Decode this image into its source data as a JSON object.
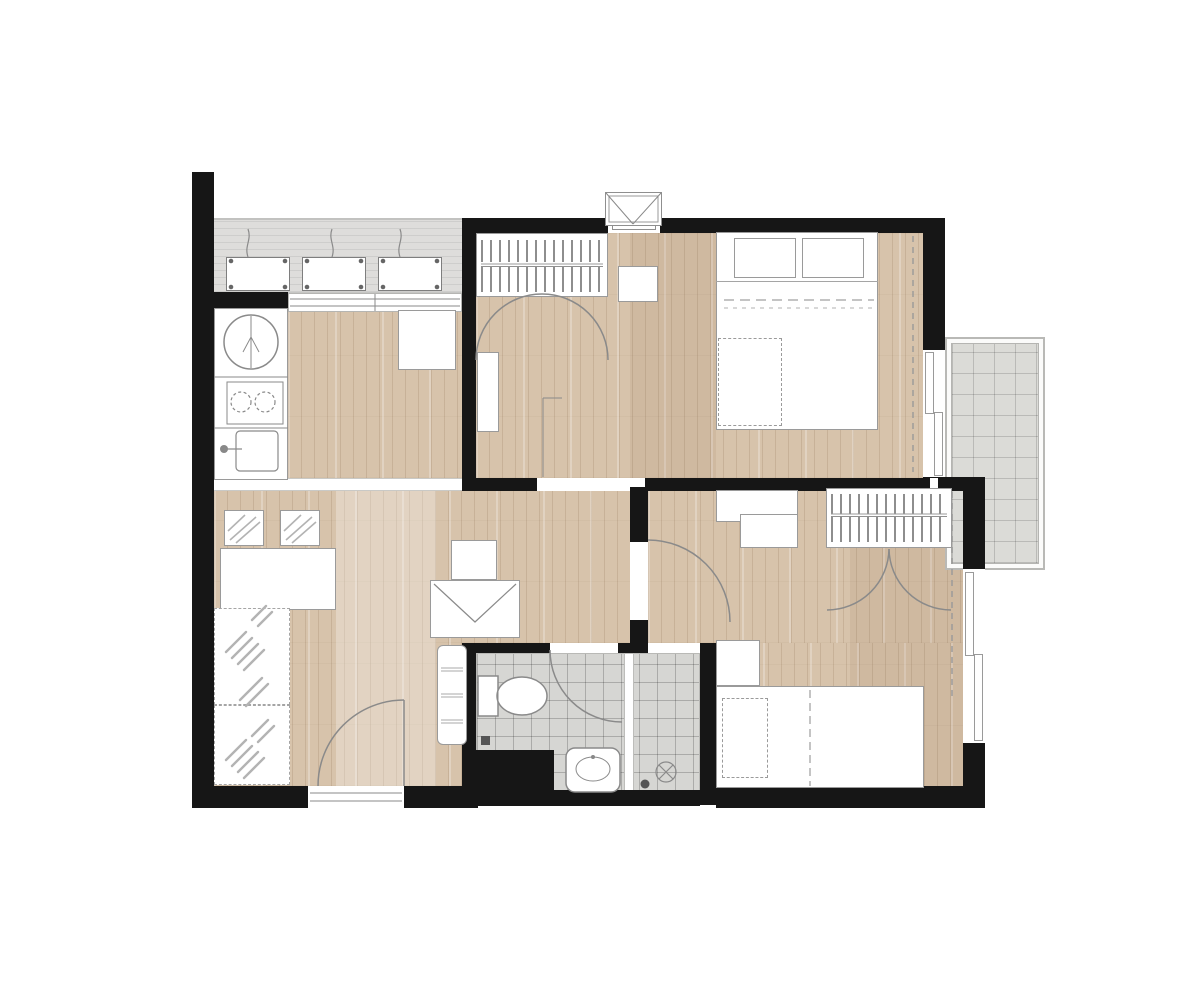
{
  "title": "Two-bedroom apartment floor plan (top view)",
  "colors": {
    "wall": "#161616",
    "wood_floor": "#d7c3ab",
    "wood_plank_line": "#b79a7c",
    "ac_ledge": "#dedddb",
    "balcony_tile": "#dbdbd7",
    "bathroom_tile": "#d6d6d3",
    "furniture_fill": "#ffffff",
    "furniture_outline": "#9a9a9a",
    "door_swing_arc": "#8a8a8a",
    "background": "#ffffff"
  },
  "rooms": [
    {
      "id": "ac-ledge",
      "symbols": [
        "ac-compressor-unit",
        "ac-compressor-unit",
        "ac-compressor-unit",
        "sliding-window-sill"
      ]
    },
    {
      "id": "kitchen",
      "symbols": [
        "counter",
        "washing-machine",
        "two-burner-cooktop",
        "kitchen-sink",
        "refrigerator"
      ]
    },
    {
      "id": "foyer",
      "symbols": [
        "wardrobe-hanging-rail",
        "double-door-swing-arcs",
        "mirror-cabinet",
        "entrance-door"
      ]
    },
    {
      "id": "service-shaft",
      "symbols": [
        "shaft-box"
      ]
    },
    {
      "id": "bedroom-1",
      "symbols": [
        "double-bed",
        "pillow",
        "pillow",
        "bed-runner",
        "nightstand",
        "curtain-line",
        "sliding-balcony-door"
      ]
    },
    {
      "id": "balcony",
      "symbols": [
        "tile-grid"
      ]
    },
    {
      "id": "living-dining",
      "symbols": [
        "dining-chair",
        "dining-chair",
        "dining-table",
        "plant-mat",
        "plant-mat",
        "desk-chair",
        "desk",
        "slim-cabinet",
        "swing-door-window"
      ]
    },
    {
      "id": "bathroom",
      "symbols": [
        "toilet",
        "washbasin",
        "shower-partition",
        "floor-drain",
        "shower-head",
        "door-swing-arc"
      ]
    },
    {
      "id": "bedroom-2",
      "symbols": [
        "desk",
        "chair",
        "wardrobe-hanging-rail",
        "wardrobe-door-swing-arcs",
        "nightstand",
        "single-bed",
        "pillow",
        "curtain-line",
        "window",
        "door-swing-arc"
      ]
    }
  ]
}
